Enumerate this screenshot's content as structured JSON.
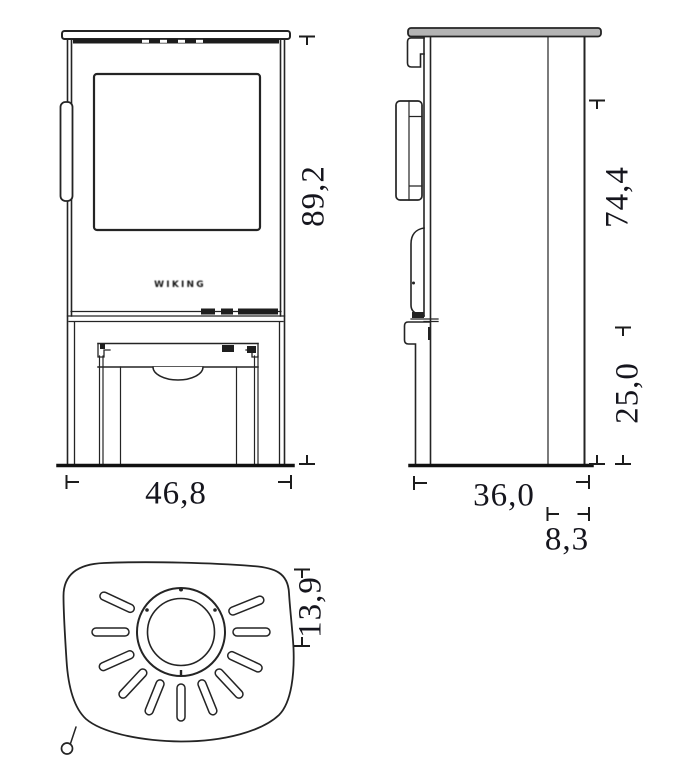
{
  "document": {
    "type": "technical-dimension-drawing",
    "subject": "wood stove, three orthographic views (front, side, top)"
  },
  "brand_logo": "WIKING",
  "dimensions": {
    "front_height": "89,2",
    "front_width": "46,8",
    "side_upper_height": "74,4",
    "side_base_height": "25,0",
    "side_depth": "36,0",
    "side_flue_offset": "8,3",
    "top_flue_offset": "13,9"
  },
  "colors": {
    "line": "#242424",
    "heavy_line": "#111111",
    "plate_fill": "#b4b4b4",
    "label_text": "#15151d",
    "background": "#ffffff"
  }
}
